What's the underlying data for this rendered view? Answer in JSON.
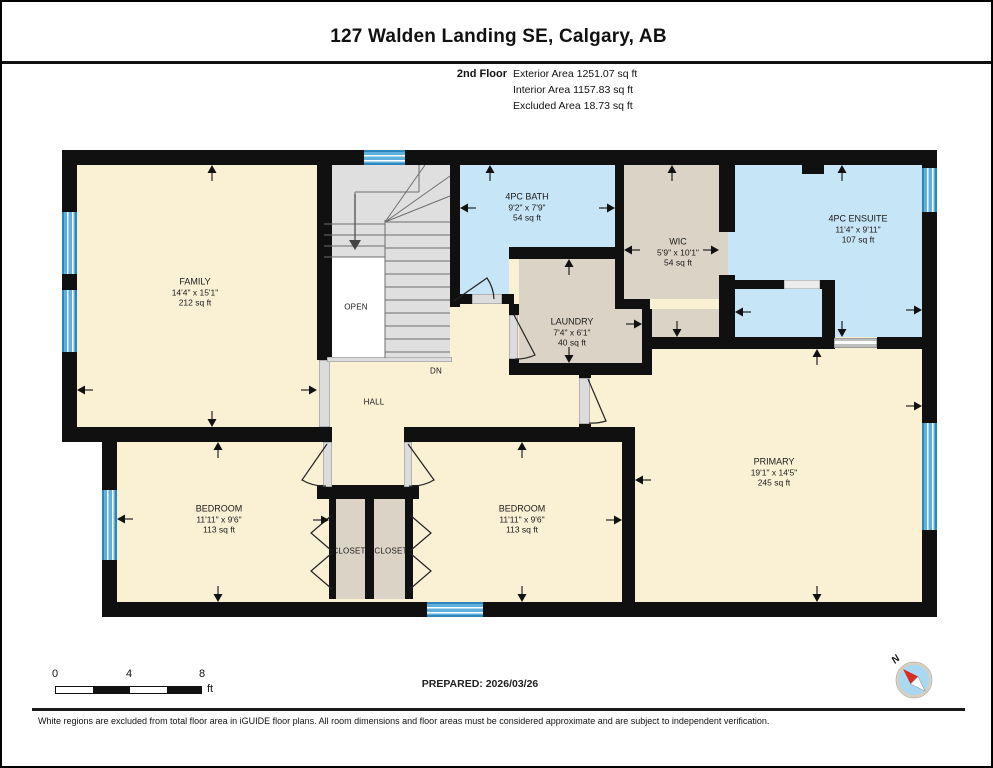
{
  "header": {
    "title": "127 Walden Landing SE, Calgary, AB",
    "floor_label": "2nd Floor",
    "area_lines": [
      "Exterior Area 1251.07 sq ft",
      "Interior Area 1157.83 sq ft",
      "Excluded Area 18.73 sq ft"
    ]
  },
  "plan": {
    "rooms": [
      {
        "id": "family",
        "name": "FAMILY",
        "dims": "14'4\" x 15'1\"",
        "area": "212 sq ft",
        "x": 193,
        "y": 290
      },
      {
        "id": "bath-4pc",
        "name": "4PC BATH",
        "dims": "9'2\" x 7'9\"",
        "area": "54 sq ft",
        "x": 525,
        "y": 205
      },
      {
        "id": "wic",
        "name": "WIC",
        "dims": "5'9\" x 10'1\"",
        "area": "54 sq ft",
        "x": 676,
        "y": 250
      },
      {
        "id": "ensuite-4pc",
        "name": "4PC ENSUITE",
        "dims": "11'4\" x 9'11\"",
        "area": "107 sq ft",
        "x": 856,
        "y": 227
      },
      {
        "id": "laundry",
        "name": "LAUNDRY",
        "dims": "7'4\" x 6'1\"",
        "area": "40 sq ft",
        "x": 570,
        "y": 330
      },
      {
        "id": "primary",
        "name": "PRIMARY",
        "dims": "19'1\" x 14'5\"",
        "area": "245 sq ft",
        "x": 772,
        "y": 470
      },
      {
        "id": "bedroom-left",
        "name": "BEDROOM",
        "dims": "11'11\" x 9'6\"",
        "area": "113 sq ft",
        "x": 217,
        "y": 517
      },
      {
        "id": "bedroom-right",
        "name": "BEDROOM",
        "dims": "11'11\" x 9'6\"",
        "area": "113 sq ft",
        "x": 520,
        "y": 517
      }
    ],
    "labels": [
      {
        "id": "closet-left",
        "text": "CLOSET",
        "x": 347,
        "y": 549
      },
      {
        "id": "closet-right",
        "text": "CLOSET",
        "x": 389,
        "y": 549
      },
      {
        "id": "open-to-below",
        "text": "OPEN",
        "x": 354,
        "y": 305
      },
      {
        "id": "hall",
        "text": "HALL",
        "x": 372,
        "y": 400
      },
      {
        "id": "stairs-down",
        "text": "DN",
        "x": 434,
        "y": 369
      }
    ]
  },
  "footer": {
    "scale_ticks": [
      "0",
      "4",
      "8"
    ],
    "scale_unit": "ft",
    "prepared": "PREPARED: 2026/03/26",
    "compass_label": "N",
    "disclaimer": "White regions are excluded from total floor area in iGUIDE floor plans. All room dimensions and floor areas must be considered approximate and are subject to independent verification."
  },
  "colors": {
    "room_yellow": "#FAF0D3",
    "room_blue": "#C6E5F7",
    "room_tan": "#DBD3C5",
    "stairs_gray": "#DFDFDF",
    "wall_black": "#101010",
    "window_blue": "#5FB0DD",
    "compass_red": "#D92B1F"
  }
}
